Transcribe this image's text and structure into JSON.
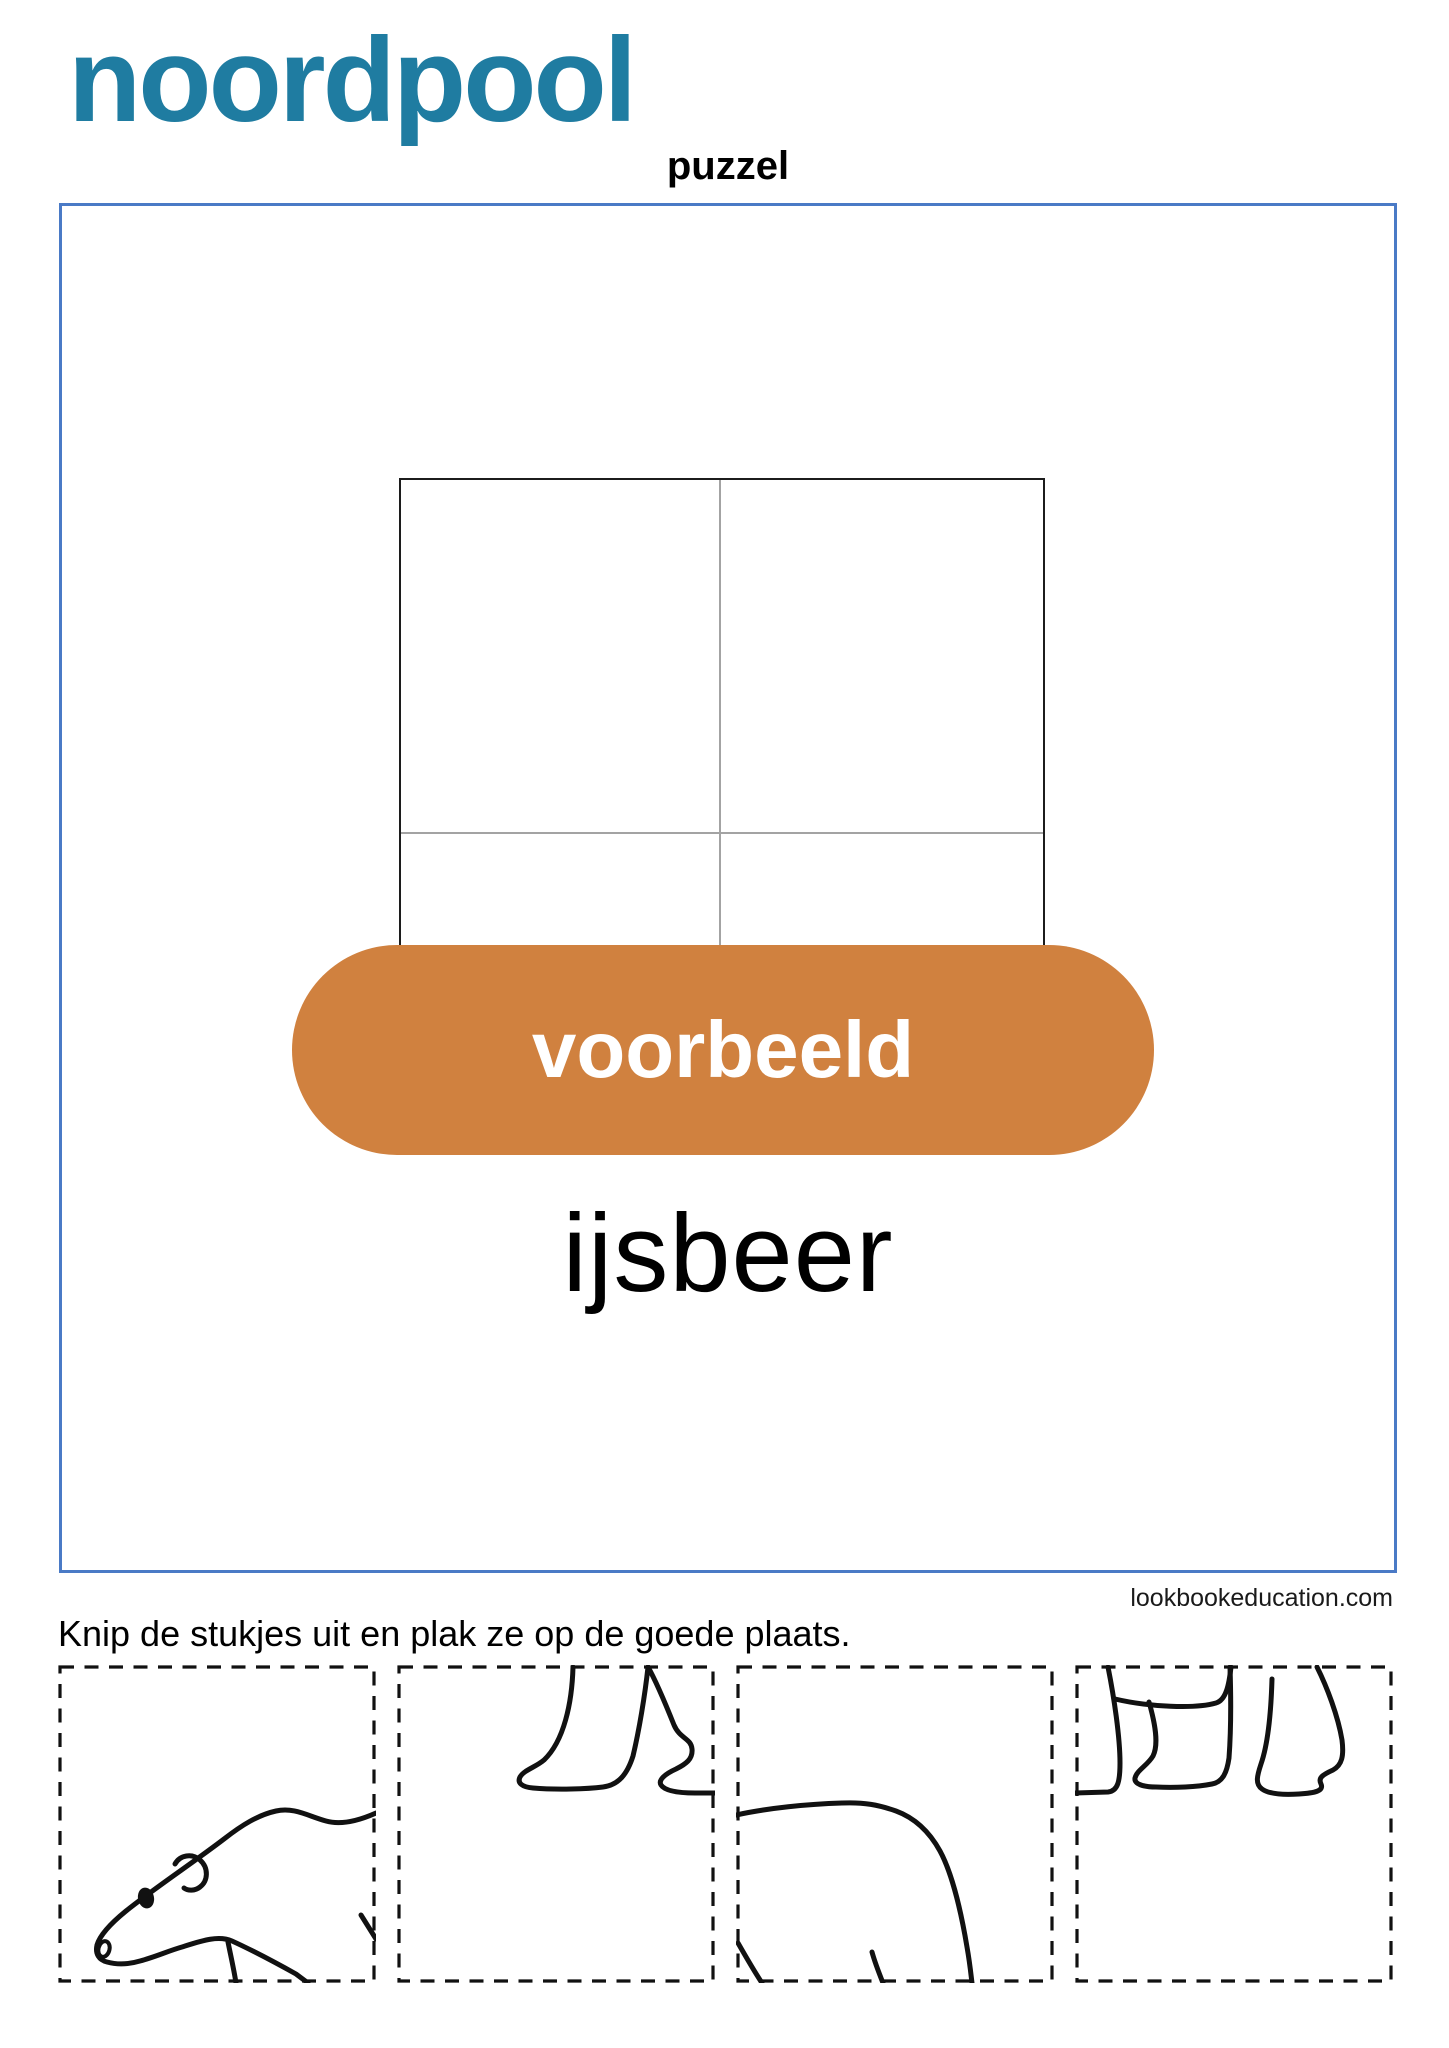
{
  "page": {
    "title": "noordpool",
    "subtitle": "puzzel",
    "instruction": "Knip de stukjes uit en plak ze op de goede plaats.",
    "credit": "lookbookeducation.com"
  },
  "example_card": {
    "badge_label": "voorbeeld",
    "word": "ijsbeer",
    "grid": {
      "rows": 2,
      "cols": 2
    }
  },
  "pieces": [
    {
      "name": "polar-bear-head-piece"
    },
    {
      "name": "polar-bear-front-legs-piece"
    },
    {
      "name": "polar-bear-back-piece"
    },
    {
      "name": "polar-bear-hind-legs-piece"
    }
  ],
  "colors": {
    "title-teal": "#1f7ca1",
    "frame-blue": "#4a7ac6",
    "pill-orange": "#d0813f",
    "ink": "#111111",
    "grid-gray": "#a3a3a3"
  }
}
